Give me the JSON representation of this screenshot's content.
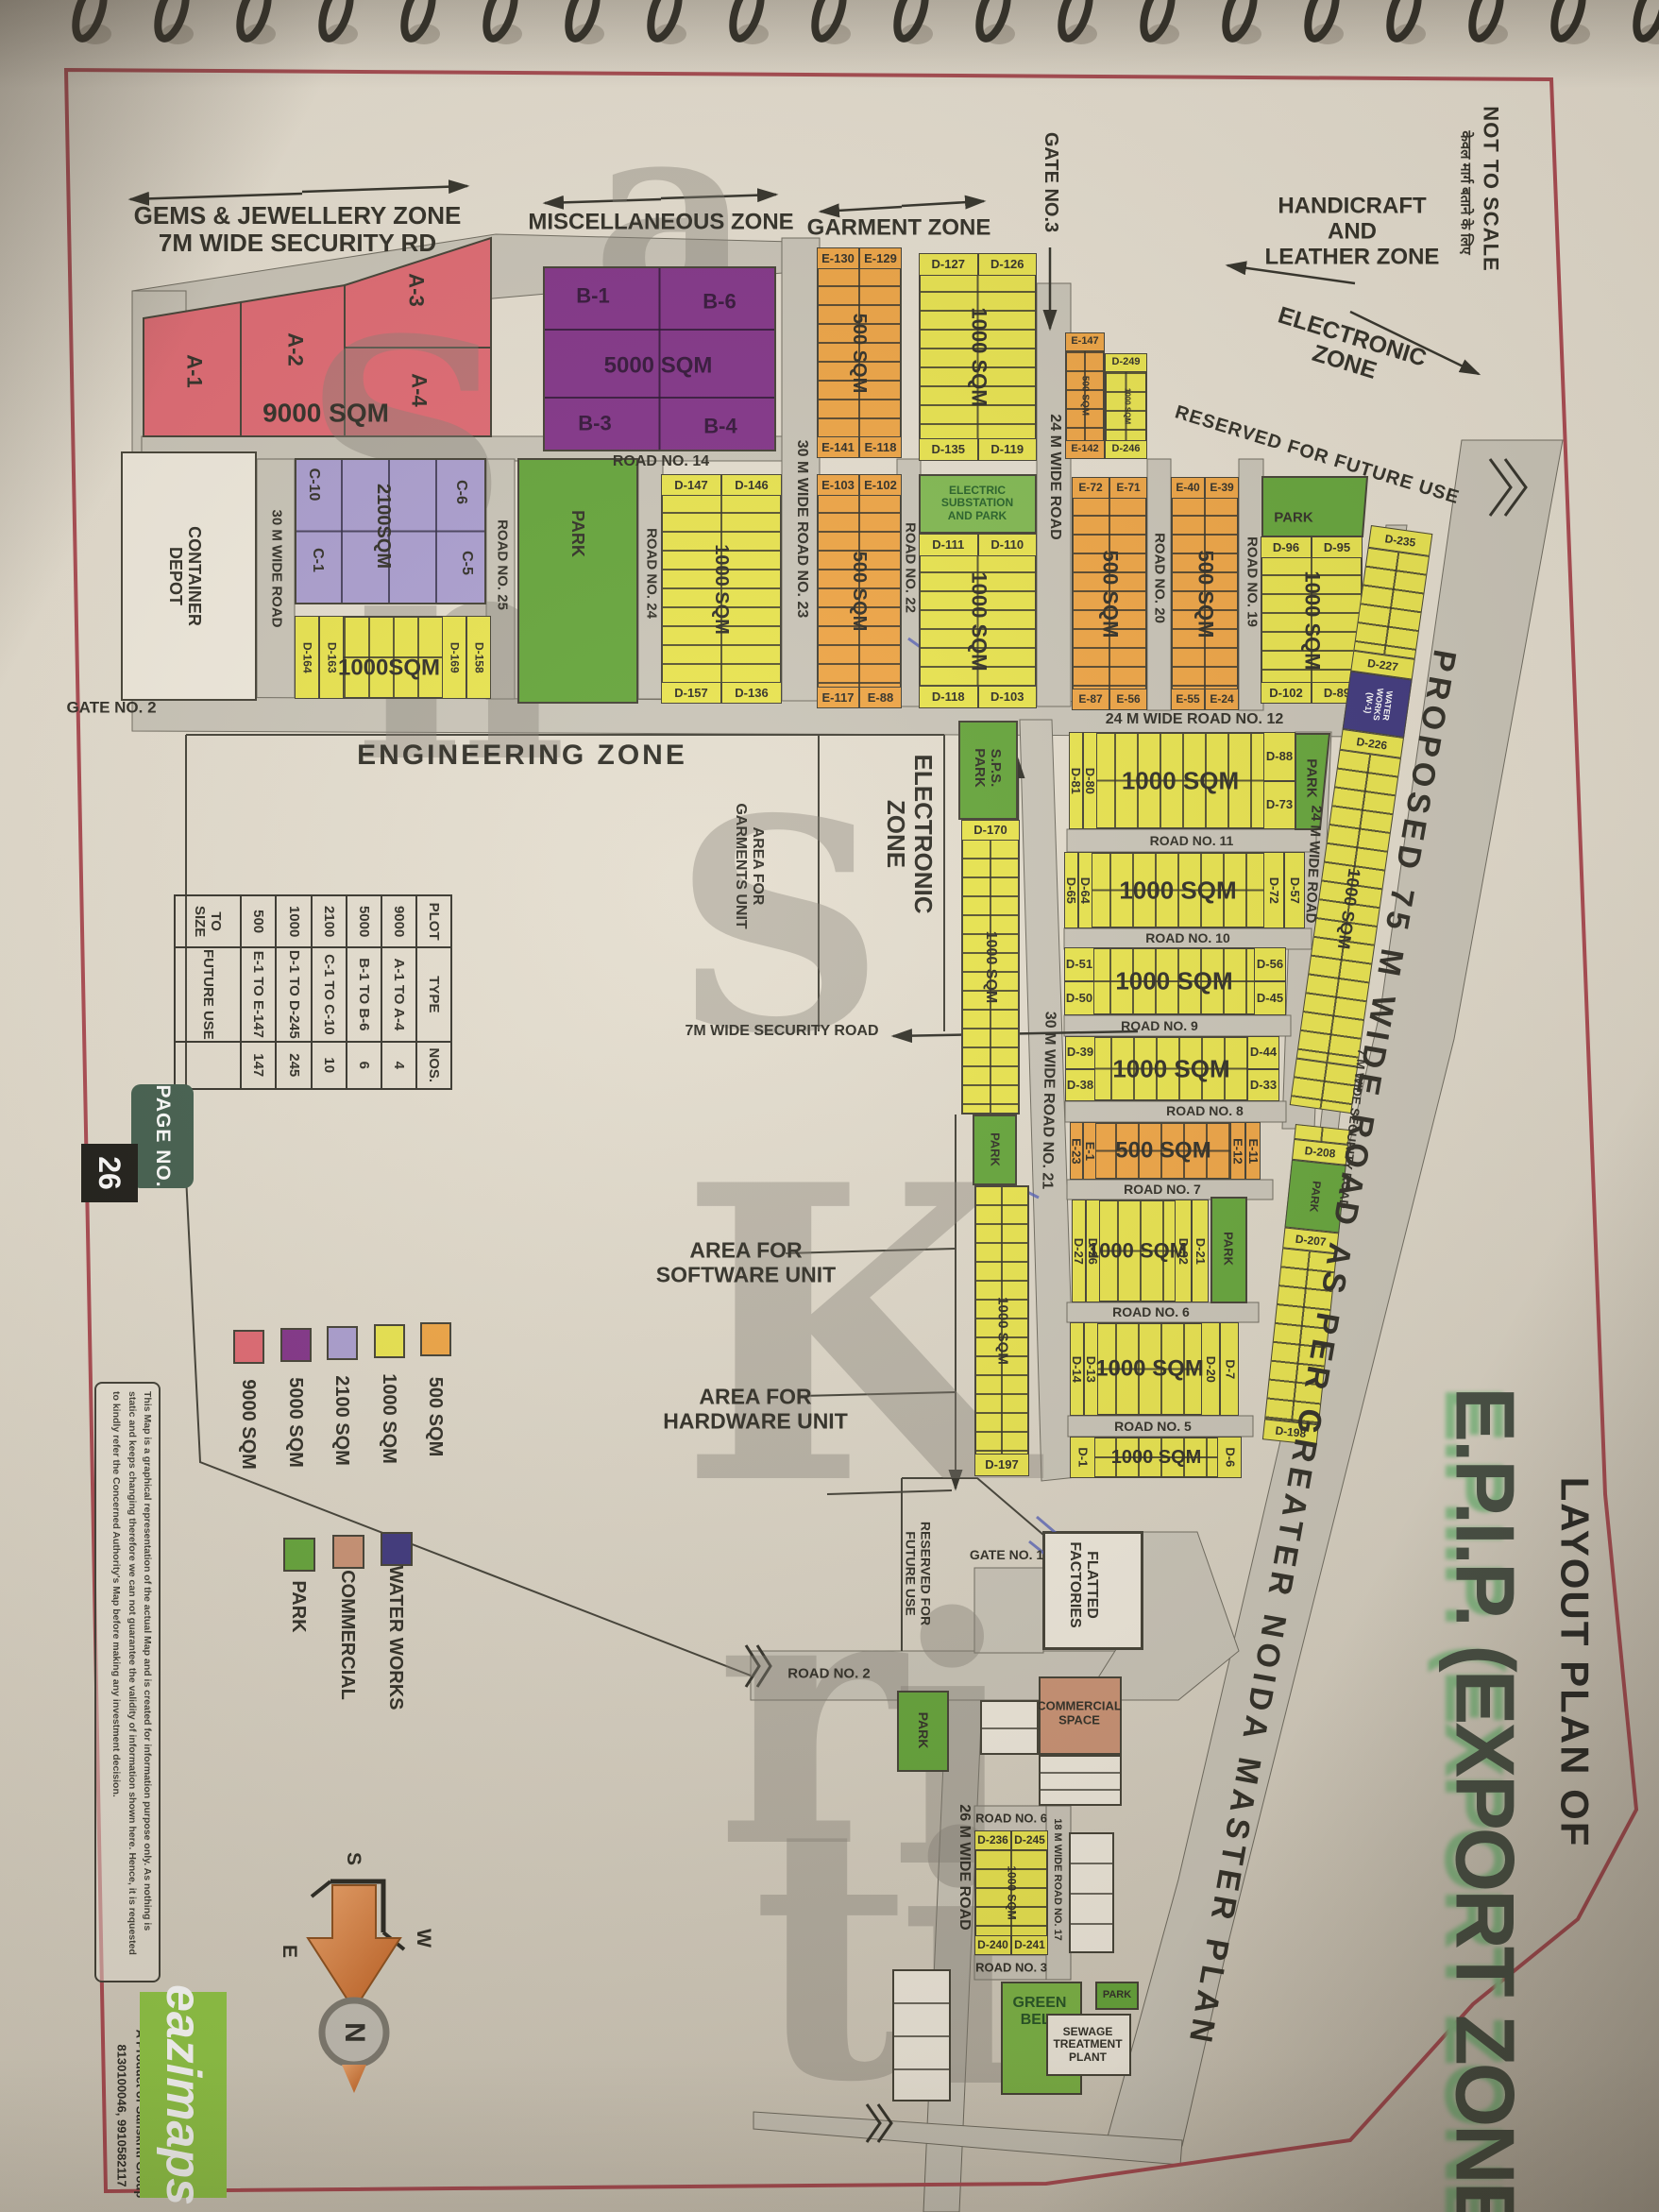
{
  "page": {
    "not_to_scale": "NOT TO SCALE",
    "hindi_note": "केवल मार्ग बताने के लिए",
    "page_no_label": "PAGE NO.",
    "page_no": "26"
  },
  "title": {
    "pre": "LAYOUT PLAN OF",
    "main": "E.P.I.P. (EXPORT ZONE)"
  },
  "watermark": "SanSKriti",
  "proposed_road": "PROPOSED 75 M WIDE ROAD AS PER GREATER NOIDA MASTER PLAN",
  "zones": {
    "gems": "GEMS & JEWELLERY ZONE\n7M WIDE SECURITY RD",
    "misc": "MISCELLANEOUS ZONE",
    "garment": "GARMENT ZONE",
    "handicraft": "HANDICRAFT\nAND\nLEATHER ZONE",
    "electronic_right": "ELECTRONIC\nZONE",
    "engineering": "ENGINEERING ZONE",
    "electronic_mid": "ELECTRONIC\nZONE",
    "reserved_upper": "RESERVED FOR FUTURE USE",
    "reserved_lower": "RESERVED FOR\nFUTURE USE"
  },
  "areas": {
    "garments": "AREA FOR\nGARMENTS UNIT",
    "software": "AREA FOR\nSOFTWARE UNIT",
    "hardware": "AREA FOR\nHARDWARE UNIT",
    "security_road_h": "7M WIDE SECURITY ROAD",
    "flatted": "FLATTED\nFACTORIES"
  },
  "gates": {
    "g1": "GATE NO. 1",
    "g2": "GATE NO. 2",
    "g3": "GATE NO.3"
  },
  "roads": {
    "r30depot": "30 M WIDE ROAD",
    "r25": "ROAD NO. 25",
    "r24": "ROAD NO. 24",
    "r23": "30 M WIDE ROAD NO. 23",
    "r22": "ROAD NO. 22",
    "r24g3": "24 M WIDE ROAD",
    "r20": "ROAD NO. 20",
    "r19": "ROAD NO. 19",
    "r14": "ROAD NO. 14",
    "r12": "24 M WIDE ROAD NO. 12",
    "r24r": "24 M WIDE ROAD",
    "r11": "ROAD NO. 11",
    "r10": "ROAD NO. 10",
    "r9": "ROAD NO. 9",
    "r8": "ROAD NO. 8",
    "r7": "ROAD NO. 7",
    "r6": "ROAD NO. 6",
    "r5": "ROAD NO. 5",
    "r21": "30 M WIDE ROAD NO. 21",
    "sec7v": "7 M WIDE SECURITY ROAD",
    "r26": "26 M WIDE ROAD",
    "r18_17": "18 M WIDE ROAD NO. 17",
    "r6b": "ROAD NO. 6",
    "r3b": "ROAD NO. 3",
    "r2": "ROAD NO. 2"
  },
  "plots": {
    "a": {
      "p1": "A-1",
      "p2": "A-2",
      "p3": "A-3",
      "p4": "A-4",
      "size": "9000 SQM"
    },
    "b": {
      "p1": "B-1",
      "p6": "B-6",
      "p3": "B-3",
      "p4": "B-4",
      "size": "5000 SQM"
    },
    "c": {
      "p10": "C-10",
      "p6": "C-6",
      "p1": "C-1",
      "p5": "C-5",
      "size": "2100SQM"
    },
    "hatchL": {
      "left": [
        "D-164",
        "D-163"
      ],
      "right": [
        "D-169",
        "D-158"
      ],
      "size": "1000SQM"
    },
    "strips": {
      "e130": {
        "top": [
          "E-130",
          "E-129"
        ],
        "bottom": [
          "E-141",
          "E-118"
        ],
        "size": "500 SQM"
      },
      "d127": {
        "top": [
          "D-127",
          "D-126"
        ],
        "bottom": [
          "D-135",
          "D-119"
        ],
        "size": "1000 SQM"
      },
      "e103": {
        "top": [
          "E-103",
          "E-102"
        ],
        "bottom": [
          "E-117",
          "E-88"
        ],
        "size": "500 SQM"
      },
      "d111": {
        "top": [
          "D-111",
          "D-110"
        ],
        "bottom": [
          "D-118",
          "D-103"
        ],
        "size": "1000 SQM",
        "hdr": "ELECTRIC\nSUBSTATION\nAND PARK"
      },
      "d147": {
        "top": [
          "D-147",
          "D-146"
        ],
        "bottom": [
          "D-157",
          "D-136"
        ],
        "size": "1000 SQM"
      },
      "e147": {
        "top": [
          "E-147"
        ],
        "bottom": [
          "E-142"
        ],
        "size": "500 SQM"
      },
      "d249": {
        "top": [
          "D-249"
        ],
        "bottom": [
          "D-246"
        ],
        "size": "1000 SQM"
      },
      "e72": {
        "top": [
          "E-72",
          "E-71"
        ],
        "bottom": [
          "E-87",
          "E-56"
        ],
        "size": "500 SQM"
      },
      "e40": {
        "top": [
          "E-40",
          "E-39"
        ],
        "bottom": [
          "E-55",
          "E-24"
        ],
        "size": "500 SQM"
      },
      "d96": {
        "top": [
          "D-96",
          "D-95"
        ],
        "bottom": [
          "D-102",
          "D-89"
        ],
        "size": "1000 SQM"
      },
      "d170a": {
        "top": [
          "D-170"
        ],
        "size": "1000 SQM"
      },
      "d170b": {
        "bottom": [
          "D-197"
        ],
        "size": "1000 SQM"
      },
      "d236": {
        "top": [
          "D-236",
          "D-245"
        ],
        "bottom": [
          "D-240",
          "D-241"
        ],
        "size": "1000 SQM"
      }
    },
    "rows": [
      {
        "left": [
          "D-81",
          "D-80"
        ],
        "right": [
          "D-88",
          "D-73"
        ],
        "size": "1000 SQM"
      },
      {
        "left": [
          "D-65",
          "D-64"
        ],
        "right": [
          "D-72",
          "D-57"
        ],
        "size": "1000 SQM"
      },
      {
        "left": [
          "D-51",
          "D-50"
        ],
        "right": [
          "D-56",
          "D-45"
        ],
        "size": "1000 SQM"
      },
      {
        "left": [
          "D-39",
          "D-38"
        ],
        "right": [
          "D-44",
          "D-33"
        ],
        "size": "1000 SQM"
      },
      {
        "left": [
          "E-23",
          "E-1"
        ],
        "right": [
          "E-12",
          "E-11"
        ],
        "size": "500 SQM"
      },
      {
        "left": [
          "D-27",
          "D-26"
        ],
        "right": [
          "D-32",
          "D-21"
        ],
        "size": "1000 SQM"
      },
      {
        "left": [
          "D-14",
          "D-13"
        ],
        "right": [
          "D-20",
          "D-7"
        ],
        "size": "1000 SQM"
      },
      {
        "left": [
          "D-1"
        ],
        "right": [
          "D-6"
        ],
        "size": "1000 SQM"
      }
    ],
    "diag235": {
      "top": "D-235",
      "mid1": "D-227",
      "mid2": "D-226",
      "size": "1000 SQM",
      "bottom": ""
    },
    "diag208": {
      "top": "D-208",
      "mid": "D-207",
      "bottom": "D-198"
    }
  },
  "facilities": {
    "container_depot": "CONTAINER\nDEPOT",
    "park": "PARK",
    "sps_park": "S.P.S.\nPARK",
    "water_works": "WATER\nWORKS\n(W-1)",
    "commercial_space": "COMMERCIAL\nSPACE",
    "green_belt": "GREEN\nBELT",
    "sewage": "SEWAGE\nTREATMENT\nPLANT"
  },
  "table": {
    "headers": [
      "PLOT",
      "TYPE",
      "NOS."
    ],
    "rows": [
      [
        "9000",
        "A-1 TO A-4",
        "4"
      ],
      [
        "5000",
        "B-1 TO B-6",
        "6"
      ],
      [
        "2100",
        "C-1 TO C-10",
        "10"
      ],
      [
        "1000",
        "D-1 TO D-245",
        "245"
      ],
      [
        "500",
        "E-1 TO E-147",
        "147"
      ],
      [
        "TO SIZE",
        "FUTURE USE",
        ""
      ]
    ]
  },
  "legend_sqm": [
    {
      "label": "9000 SQM",
      "color": "#e0646e"
    },
    {
      "label": "5000 SQM",
      "color": "#7e2c85"
    },
    {
      "label": "2100 SQM",
      "color": "#a89bcf"
    },
    {
      "label": "1000 SQM",
      "color": "#e9e448"
    },
    {
      "label": "500 SQM",
      "color": "#efa23e"
    }
  ],
  "legend_use": [
    {
      "label": "PARK",
      "color": "#5fa233"
    },
    {
      "label": "COMMERCIAL",
      "color": "#c98f70"
    },
    {
      "label": "WATER WORKS",
      "color": "#37307a"
    }
  ],
  "compass": {
    "n": "N",
    "s": "S",
    "e": "E",
    "w": "W"
  },
  "footer": {
    "disclaimer_l1": "This Map is a graphical representation of the actual Map and is created for information purpose only. As nothing is",
    "disclaimer_l2": "static and keeps changing therefore we can not guarantee the validity of information shown here. Hence, it is requested",
    "disclaimer_l3": "to kindly refer the Concerned Authority's Map before making any investment decision.",
    "brand": "eazimaps",
    "product_line": "A Product of Sanskriti Group",
    "phone": "8130100046, 9910582117"
  },
  "colors": {
    "plot_9000": "#e0646e",
    "plot_5000": "#7e2c85",
    "plot_2100": "#a89bcf",
    "plot_1000": "#e9e448",
    "plot_500": "#efa23e",
    "park": "#5fa233",
    "park_lt": "#7cb74b",
    "commercial": "#c98f70",
    "water_works": "#37307a",
    "road": "#c8c3b6",
    "cream": "#efe9dc",
    "frame_red": "#a8434b",
    "title_green": "#3e473c",
    "title_shadow": "#84bb84",
    "brand_green": "#8dc63f"
  }
}
